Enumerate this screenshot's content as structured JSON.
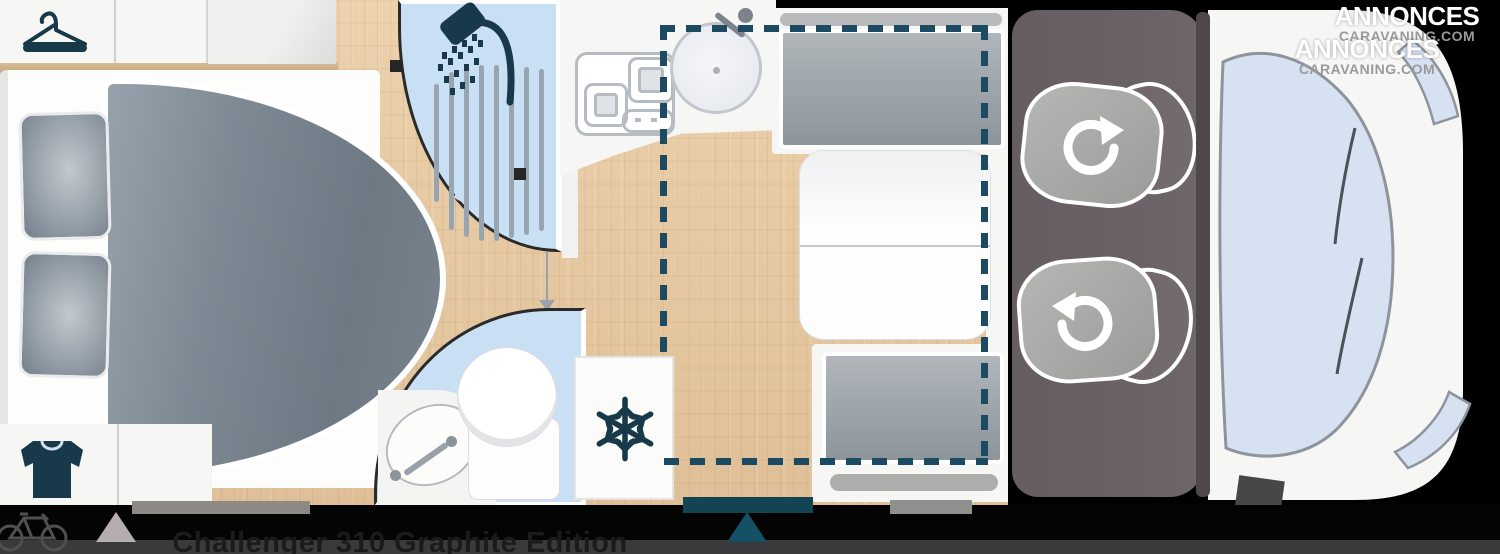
{
  "watermarks": [
    {
      "line1": "ANNONCES",
      "line2": "CARAVANING.COM"
    },
    {
      "line1": "ANNONCES",
      "line2": "CARAVANING.COM"
    }
  ],
  "footer": {
    "model_title": "Challenger 310 Graphite Edition"
  },
  "icons": [
    "hanger-icon",
    "tshirt-icon",
    "shower-head-icon",
    "stove-burners-icon",
    "kitchen-sink-icon",
    "snowflake-fridge-icon",
    "washbasin-icon",
    "toilet-icon",
    "swivel-arrow-icon",
    "bicycle-icon",
    "triangle-marker-icon",
    "drop-down-bed-dashed-outline"
  ],
  "colors": {
    "accent": "#17394a",
    "dash": "#1d4a63",
    "wood": "#e6c9a2",
    "room-blue": "#c9dff4",
    "duvet": "#7d8892",
    "cushion-gray": "#9aa1a6",
    "cab-floor": "#6a6166",
    "windshield": "#d6e1f2",
    "body-white": "#f6f6f5",
    "footer-strip": "#3a3a3c",
    "teal": "#134453",
    "title-text": "#1b1b1b"
  }
}
